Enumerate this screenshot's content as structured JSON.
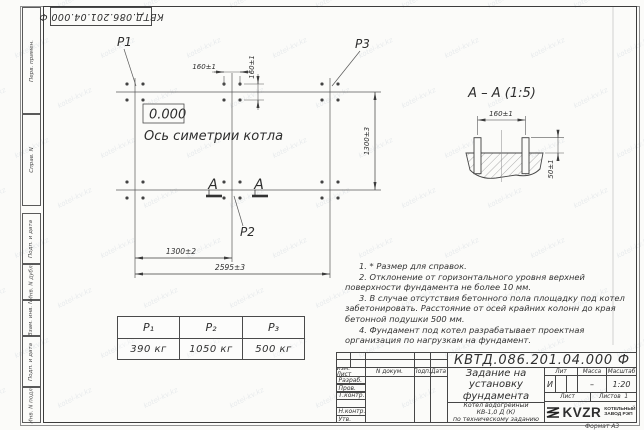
{
  "watermark": {
    "text": "kotel-kv.kz"
  },
  "stamp_top": {
    "doc_number": "КВТД.086.201.04.000 Ф"
  },
  "margin_labels": [
    "Перв. примен.",
    "Справ. N",
    "Подп. и дата",
    "Инв. N дубл.",
    "Взам. инв. N",
    "Подп. и дата",
    "Инв. N подл."
  ],
  "plan": {
    "elevation": "0.000",
    "axis_label": "Ось симетрии котла",
    "points": {
      "p1": "P1",
      "p2": "P2",
      "p3": "P3"
    },
    "dims": {
      "bolt_spacing_h": "160±1",
      "bolt_spacing_v": "160±1",
      "length_side": "1300±3",
      "width_half": "1300±2",
      "width_total": "2595±3"
    },
    "section_letter_left": "А",
    "section_letter_right": "А"
  },
  "section_view": {
    "title": "А – А (1:5)",
    "dims": {
      "bolt_spacing": "160±1",
      "protrusion": "50±1"
    }
  },
  "notes": [
    "1. * Размер для справок.",
    "2. Отклонение от горизонтального уровня верхней поверхности фундамента не более 10 мм.",
    "3. В случае отсутствия бетонного пола площадку под котел забетонировать. Расстояние от осей крайних колонн до края бетонной подушки 500 мм.",
    "4. Фундамент под котел разрабатывает проектная организация по нагрузкам на фундамент."
  ],
  "loads_table": {
    "headers": [
      "Р₁",
      "Р₂",
      "Р₃"
    ],
    "values": [
      "390 кг",
      "1050 кг",
      "500 кг"
    ]
  },
  "title_block": {
    "doc_number": "КВТД.086.201.04.000 Ф",
    "header_cols": [
      "Изм. Лист",
      "N докум.",
      "Подп.",
      "Дата"
    ],
    "rows": [
      "Разраб.",
      "Пров.",
      "Т.контр.",
      "",
      "Н.контр.",
      "Утв."
    ],
    "title": "Задание на установку фундамента",
    "subtitle_lines": [
      "Котел водогрейный",
      "КВ-1,0 Д (К)",
      "по техническому заданию"
    ],
    "lit_label": "Лит",
    "mass_label": "Масса",
    "scale_label": "Масштаб",
    "lit_value": "И",
    "mass_value": "–",
    "scale_value": "1:20",
    "sheet_label": "Лист",
    "sheets_label": "Листов",
    "sheets_value": "1",
    "logo_text": "KVZR",
    "org_lines": [
      "КОТЕЛЬНЫЙ",
      "ЗАВОД РЭП"
    ],
    "format_label": "Формат А3"
  }
}
